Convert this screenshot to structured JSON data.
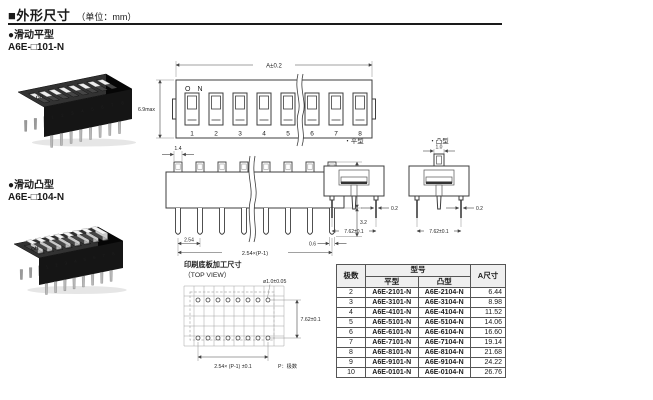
{
  "page": {
    "title": "■外形尺寸",
    "unit_note": "（单位：mm）"
  },
  "sections": {
    "flat": {
      "label": "●滑动平型",
      "model": "A6E-□101-N"
    },
    "raised": {
      "label": "●滑动凸型",
      "model": "A6E-□104-N"
    }
  },
  "photo": {
    "on_label": "ON",
    "digits": "12345678"
  },
  "front_view": {
    "on_label": "ON",
    "positions": [
      "1",
      "2",
      "3",
      "4",
      "5",
      "6",
      "7",
      "8"
    ],
    "dim_width": "A±0.2",
    "dim_height": "6.9max"
  },
  "side_elevation": {
    "dim_actuator_width": "1.4",
    "dim_actuator_height": "1.2",
    "dim_body_height": "5.85",
    "dim_pin_length": "3.2",
    "dim_pitch": "2.54",
    "dim_overall": "2.54×(P-1)",
    "dim_terminal_width": "0.6"
  },
  "side_views": {
    "flat_label": "・平型",
    "raised_label": "・凸型",
    "dim_actuator_width": "1.0",
    "dim_lead_thickness_flat": "0.2",
    "dim_lead_thickness_raised": "0.2",
    "dim_row_spacing_flat": "7.62±0.1",
    "dim_row_spacing_raised": "7.62±0.1"
  },
  "pcb_view": {
    "title": "印刷底板加工尺寸",
    "subtitle": "（TOP VIEW）",
    "dim_hole": "ø1.0±0.05",
    "dim_row_spacing": "7.62±0.1",
    "dim_pitch": "2.54× (P-1) ±0.1",
    "note_poles": "P：极数"
  },
  "model_table": {
    "col_poles": "极数",
    "col_model": "型号",
    "col_flat": "平型",
    "col_raised": "凸型",
    "col_a": "A尺寸",
    "rows": [
      {
        "poles": "2",
        "flat": "A6E-2101-N",
        "raised": "A6E-2104-N",
        "a": "6.44"
      },
      {
        "poles": "3",
        "flat": "A6E-3101-N",
        "raised": "A6E-3104-N",
        "a": "8.98"
      },
      {
        "poles": "4",
        "flat": "A6E-4101-N",
        "raised": "A6E-4104-N",
        "a": "11.52"
      },
      {
        "poles": "5",
        "flat": "A6E-5101-N",
        "raised": "A6E-5104-N",
        "a": "14.06"
      },
      {
        "poles": "6",
        "flat": "A6E-6101-N",
        "raised": "A6E-6104-N",
        "a": "16.60"
      },
      {
        "poles": "7",
        "flat": "A6E-7101-N",
        "raised": "A6E-7104-N",
        "a": "19.14"
      },
      {
        "poles": "8",
        "flat": "A6E-8101-N",
        "raised": "A6E-8104-N",
        "a": "21.68"
      },
      {
        "poles": "9",
        "flat": "A6E-9101-N",
        "raised": "A6E-9104-N",
        "a": "24.22"
      },
      {
        "poles": "10",
        "flat": "A6E-0101-N",
        "raised": "A6E-0104-N",
        "a": "26.76"
      }
    ]
  },
  "colors": {
    "ink": "#1a1a1a",
    "line": "#444444",
    "body_black": "#141414"
  }
}
